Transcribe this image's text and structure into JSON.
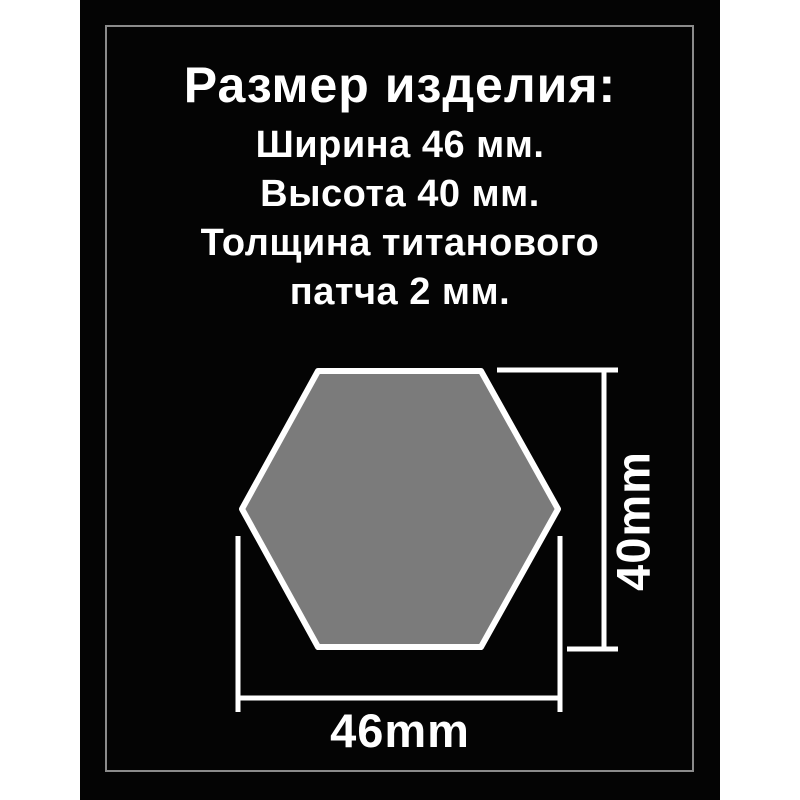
{
  "card": {
    "background_color": "#040404",
    "page_background_color": "#ffffff",
    "frame_border_color": "#8b8b8b",
    "text_color": "#ffffff"
  },
  "header": {
    "title": "Размер изделия:",
    "lines": [
      "Ширина 46 мм.",
      "Высота 40 мм.",
      "Толщина титанового",
      "патча 2 мм."
    ]
  },
  "diagram": {
    "shape": "hexagon",
    "hexagon_fill_color": "#7b7b7b",
    "outline_color": "#ffffff",
    "width_label": "46mm",
    "height_label": "40mm"
  }
}
